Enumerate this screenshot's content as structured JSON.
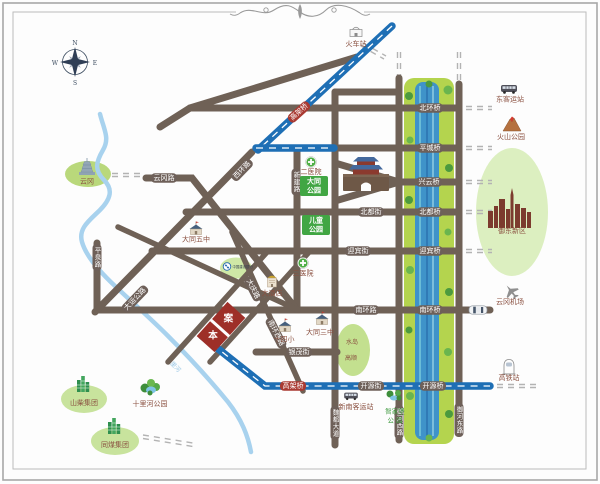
{
  "compass": {
    "north": "N",
    "south": "S",
    "east": "E",
    "west": "W"
  },
  "roads": {
    "yungang_road": "云冈路",
    "xihuan_road": "西环路",
    "dayun_highway": "大运公路",
    "pingquan_road": "平泉路",
    "xinjian_road": "新建路",
    "weidu_avenue": "魏都大道",
    "yuhe_west_road": "御河西路",
    "yuhe_east_road": "御河东路",
    "beidu_street": "北都街",
    "yingbin_street": "迎宾街",
    "nanhuan_road": "南环路",
    "yinmao_street": "银茂街",
    "kaiyuan_street": "开源街",
    "daqing_road": "大庆路",
    "nanhuan_west_road": "南环西路",
    "elevated_bridge": "高架桥"
  },
  "bridges": {
    "beihuan": "北环桥",
    "pingcheng": "平城桥",
    "xingyun": "兴云桥",
    "beidu": "北都桥",
    "yingbin": "迎宾桥",
    "nanhuan": "南环桥",
    "kaiyuan": "开源桥"
  },
  "river": {
    "name": "十里河"
  },
  "site": {
    "char_top": "案",
    "char_bottom": "本"
  },
  "pois": {
    "yungang": "云冈",
    "train_station": "火车站",
    "east_bus_station": "东客运站",
    "volcano_park": "火山公园",
    "yudong_new_district": "御东新区",
    "yungang_airport": "云冈机场",
    "hsr_station": "高铁站",
    "datong_park": {
      "line1": "大同",
      "line2": "公园"
    },
    "children_park": {
      "line1": "儿童",
      "line2": "公园"
    },
    "no2_hospital": "二医院",
    "no3_hospital": "三医院",
    "datong_no5_middle": "大同五中",
    "datong_no3_middle": "大同三中",
    "no14_primary": "十四小",
    "grand_hotel": "大酒店",
    "ccb_bank": "中国建设银行",
    "shanchai_group": "山柴集团",
    "tongmei_group": "同煤集团",
    "shilihe_park": "十里河公园",
    "zhijiabao_park": {
      "line1": "智家堡",
      "line2": "公 园"
    },
    "new_south_bus_station": "新南客运站",
    "shuidao": "水岛",
    "gaoshun": "高顺"
  },
  "colors": {
    "road": "#6f6156",
    "road_cap": "#6e6059",
    "bridge_cap_red": "#a93a32",
    "expressway_blue": "#1e6fb5",
    "river_blue": "#a8d2ee",
    "park_green": "#b4d44e",
    "water": "#3f93c9",
    "site_red": "#9e2f28",
    "park_box_green": "#41a643",
    "poi_label": "#8a5040",
    "park_label_green": "#3f9a3f"
  }
}
